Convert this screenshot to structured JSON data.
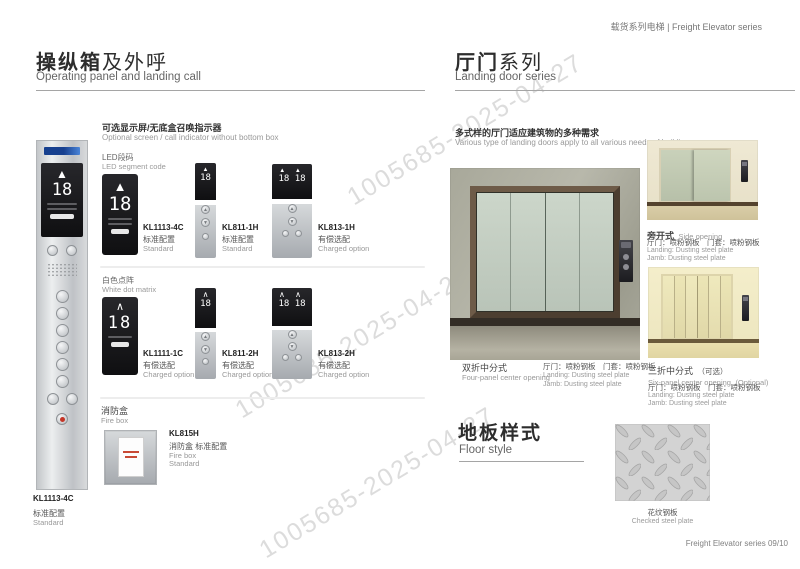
{
  "colors": {
    "brand_blue": "#1e4f9e",
    "alarm_red": "#c43527",
    "watermark_gray": "#dcdcdc",
    "display_black": "#131315",
    "panel_silver": "#cfd2d5"
  },
  "watermark": {
    "text": "1005685-2025-04-27"
  },
  "header": {
    "text": "载货系列电梯 | Freight Elevator series"
  },
  "footer": {
    "text": "Freight Elevator series  09/10"
  },
  "left_page": {
    "title_cn_bold": "操纵箱",
    "title_cn_rest": "及外呼",
    "title_en": "Operating panel and landing call",
    "cop": {
      "display_value": "18",
      "up_arrow": "▲",
      "model": "KL1113-4C",
      "config_cn": "标准配置",
      "config_en": "Standard"
    },
    "optional": {
      "title_cn": "可选显示屏/无底盒召唤指示器",
      "title_en": "Optional screen / call indicator without bottom box",
      "group1_cn": "LED段码",
      "group1_en": "LED segment code",
      "group2_cn": "白色点阵",
      "group2_en": "White dot matrix",
      "items": [
        {
          "model": "KL1113-4C",
          "cfg_cn": "标准配置",
          "cfg_en": "Standard",
          "display": "18",
          "arrow": "▲"
        },
        {
          "model": "KL811-1H",
          "cfg_cn": "标准配置",
          "cfg_en": "Standard",
          "display": "18",
          "arrow": "▲"
        },
        {
          "model": "KL813-1H",
          "cfg_cn": "有偿选配",
          "cfg_en": "Charged option",
          "display": "18 18",
          "arrow": "▲ ▲"
        },
        {
          "model": "KL1111-1C",
          "cfg_cn": "有偿选配",
          "cfg_en": "Charged option",
          "display": "18",
          "arrow": "∧"
        },
        {
          "model": "KL811-2H",
          "cfg_cn": "有偿选配",
          "cfg_en": "Charged option",
          "display": "18",
          "arrow": "∧"
        },
        {
          "model": "KL813-2H",
          "cfg_cn": "有偿选配",
          "cfg_en": "Charged option",
          "display": "18 18",
          "arrow": "∧ ∧"
        }
      ]
    },
    "firebox": {
      "title_cn": "消防盒",
      "title_en": "Fire box",
      "model": "KL815H",
      "desc_cn": "消防盒 标准配置",
      "desc_en1": "Fire box",
      "desc_en2": "Standard"
    }
  },
  "right_page": {
    "title_cn_bold": "厅门",
    "title_cn_rest": "系列",
    "title_en": "Landing  door series",
    "intro_cn": "多式样的厅门适应建筑物的多种需求",
    "intro_en": "Various type of landing doors apply to all various needs of buildings",
    "doors": [
      {
        "name_cn": "双折中分式",
        "name_en": "Four-panel center opening",
        "spec_cn": "厅门：喷粉钢板　门套：喷粉钢板",
        "spec_en1": "Landing: Dusting steel plate",
        "spec_en2": "Jamb: Dusting steel plate"
      },
      {
        "name_cn": "旁开式",
        "name_en": "Side opening",
        "spec_cn": "厅门：喷粉钢板　门套：喷粉钢板",
        "spec_en1": "Landing: Dusting steel plate",
        "spec_en2": "Jamb: Dusting steel plate"
      },
      {
        "name_cn": "三折中分式",
        "name_cn_note": "（可选）",
        "name_en": "Six-panel center opening",
        "name_en_note": "(Optional)",
        "spec_cn": "厅门：喷粉钢板　门套：喷粉钢板",
        "spec_en1": "Landing: Dusting steel plate",
        "spec_en2": "Jamb: Dusting steel plate"
      }
    ],
    "floor": {
      "title_cn": "地板样式",
      "title_en": "Floor style",
      "item_cn": "花纹钢板",
      "item_en": "Checked steel plate"
    }
  }
}
